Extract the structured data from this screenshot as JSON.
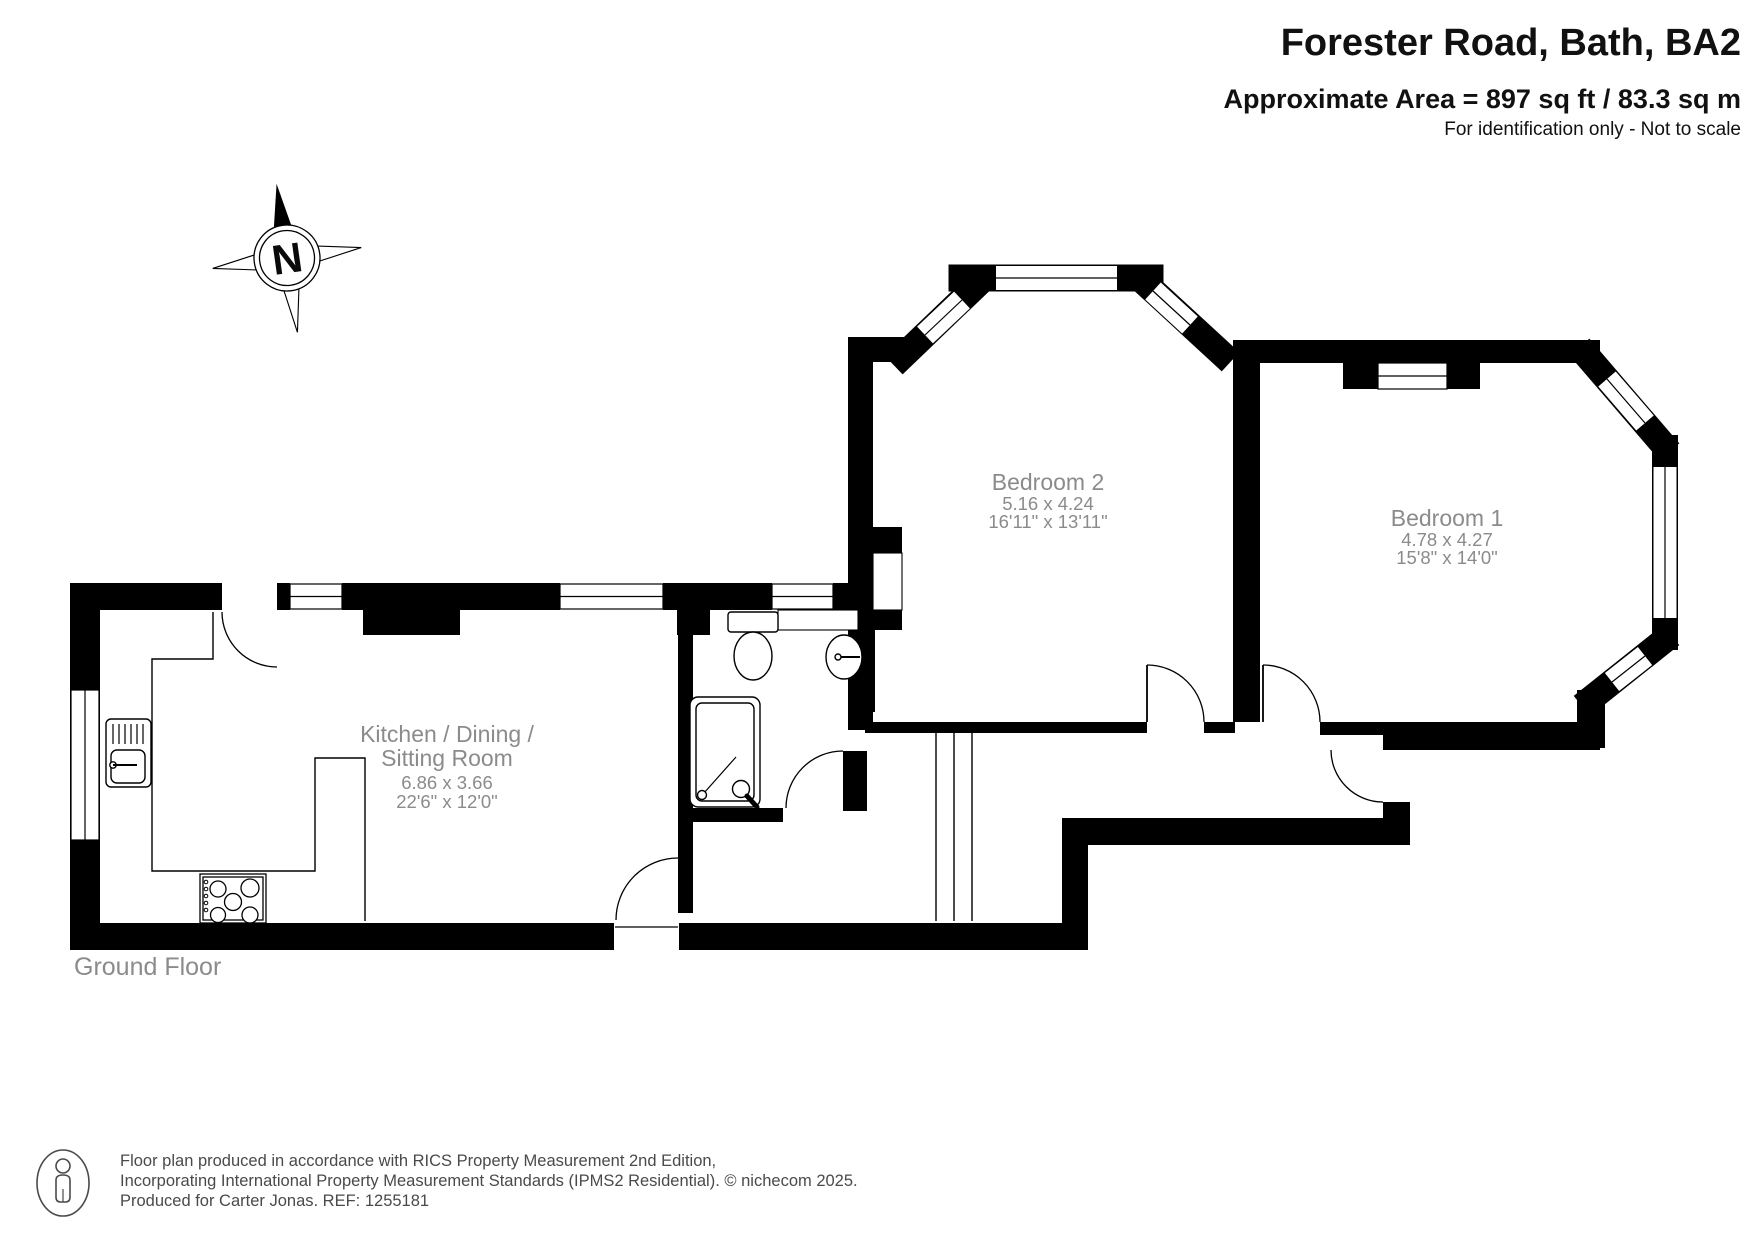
{
  "header": {
    "title": "Forester Road, Bath, BA2",
    "area_line": "Approximate Area = 897 sq ft / 83.3 sq m",
    "disclaimer": "For identification only - Not to scale"
  },
  "compass": {
    "label": "N"
  },
  "floor_label": "Ground Floor",
  "rooms": {
    "kitchen": {
      "name_line1": "Kitchen / Dining /",
      "name_line2": "Sitting Room",
      "metric": "6.86 x 3.66",
      "imperial": "22'6\" x 12'0\""
    },
    "bedroom2": {
      "name": "Bedroom 2",
      "metric": "5.16 x 4.24",
      "imperial": "16'11\" x 13'11\""
    },
    "bedroom1": {
      "name": "Bedroom 1",
      "metric": "4.78 x 4.27",
      "imperial": "15'8\" x 14'0\""
    }
  },
  "footer": {
    "line1": "Floor plan produced in accordance with RICS Property Measurement 2nd Edition,",
    "line2": "Incorporating International Property Measurement Standards (IPMS2 Residential).   © nichecom 2025.",
    "line3": "Produced for Carter Jonas.   REF: 1255181"
  },
  "colors": {
    "wall": "#000000",
    "label_gray": "#8b8b8b",
    "footer_gray": "#4a4a4a"
  }
}
